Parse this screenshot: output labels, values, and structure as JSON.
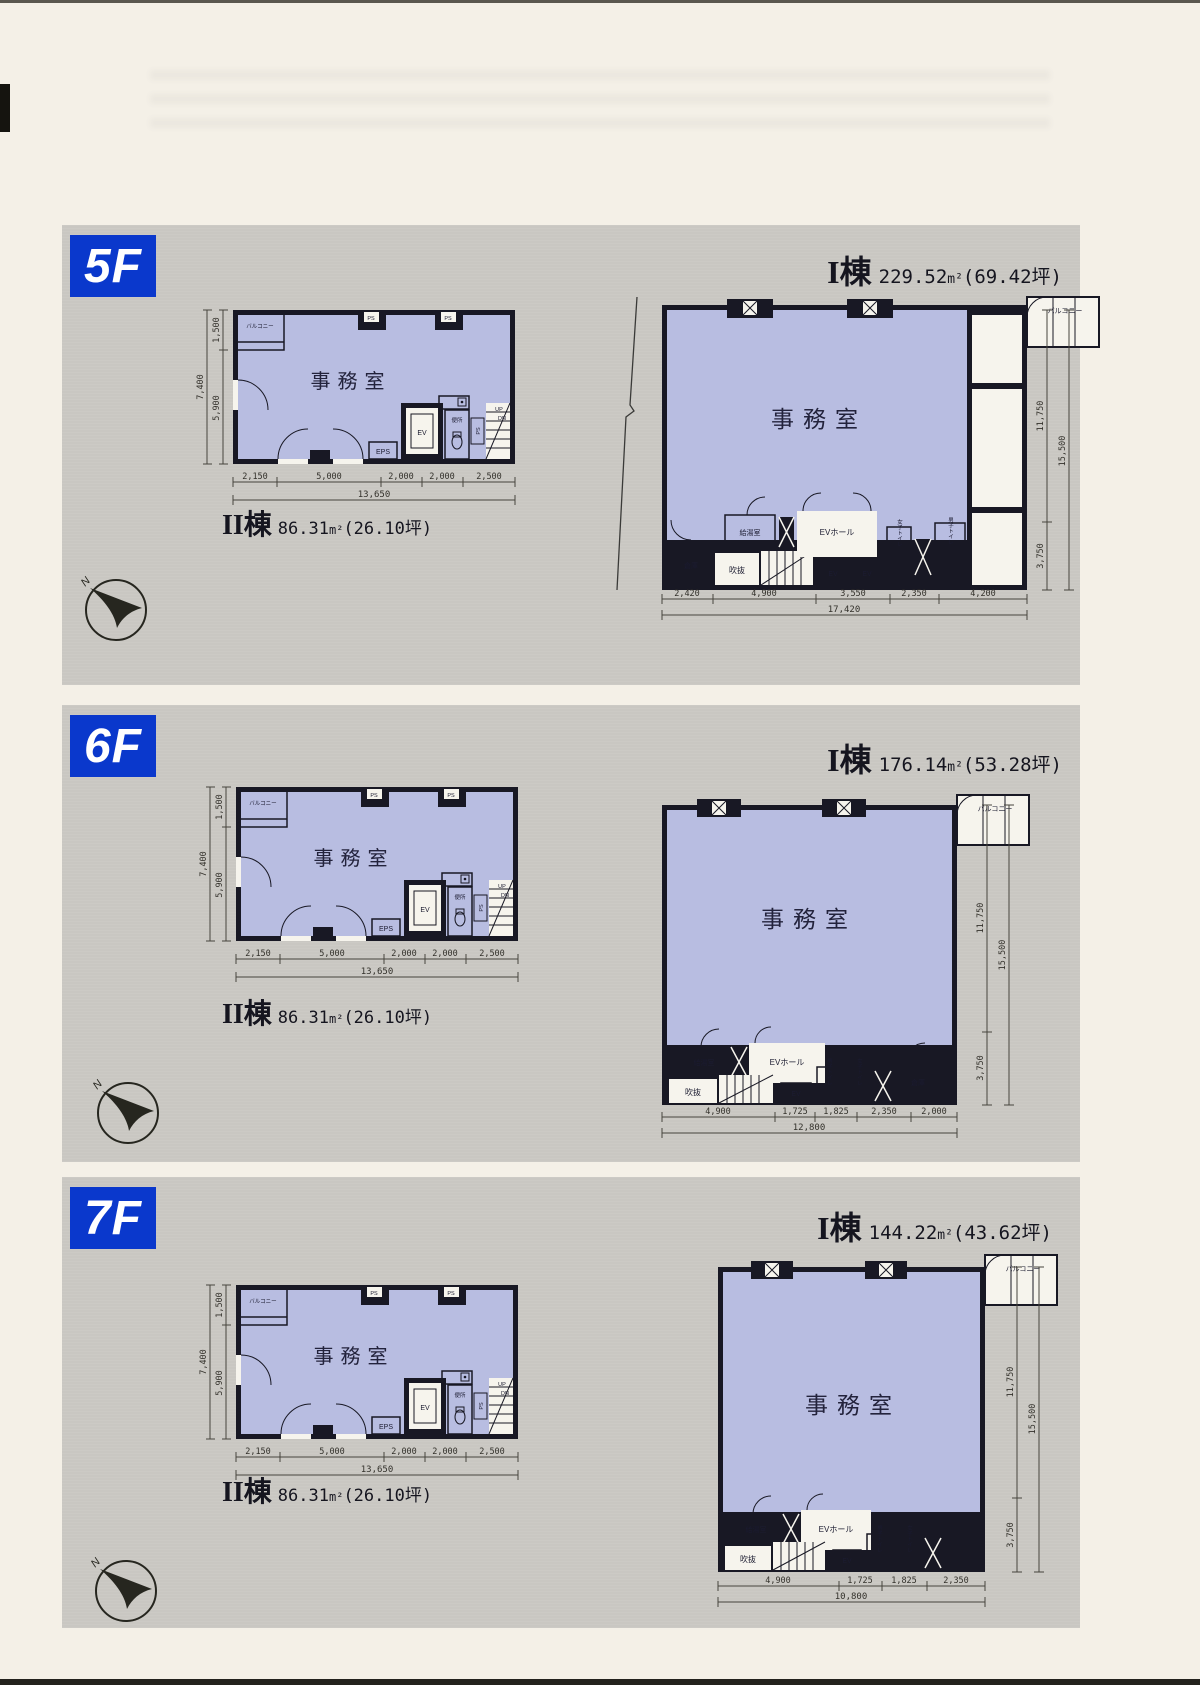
{
  "page": {
    "compass_label": "N"
  },
  "shared": {
    "office": "事務室",
    "balcony": "バルコニー",
    "ev": "EV",
    "ev_hall": "EVホール",
    "kitchenette": "給湯室",
    "toilet": "便所",
    "eps": "EPS",
    "ps": "PS",
    "up": "UP",
    "dn": "DN",
    "void_space": "吹抜",
    "storage": "倉庫",
    "womens_toilet": "女子トイレ",
    "mens_toilet": "男子トイレ"
  },
  "wing2": {
    "name": "II棟",
    "area": "86.31",
    "area_unit": "m²",
    "tsubo": "(26.10坪)",
    "dims_left": [
      "1,500",
      "5,900",
      "7,400"
    ],
    "dims_bottom": [
      "2,150",
      "5,000",
      "2,000",
      "2,000",
      "2,500"
    ],
    "dims_bottom_total": "13,650"
  },
  "floors": [
    {
      "badge": "5F",
      "wing1": {
        "name": "I棟",
        "area": "229.52",
        "area_unit": "m²",
        "tsubo": "(69.42坪)",
        "dims_bottom": [
          "2,420",
          "4,900",
          "3,550",
          "2,350",
          "4,200"
        ],
        "dims_bottom_total": "17,420",
        "dims_right": [
          "11,750",
          "3,750",
          "15,500"
        ]
      }
    },
    {
      "badge": "6F",
      "wing1": {
        "name": "I棟",
        "area": "176.14",
        "area_unit": "m²",
        "tsubo": "(53.28坪)",
        "dims_bottom": [
          "4,900",
          "1,725",
          "1,825",
          "2,350",
          "2,000"
        ],
        "dims_bottom_total": "12,800",
        "dims_right": [
          "11,750",
          "3,750",
          "15,500"
        ]
      }
    },
    {
      "badge": "7F",
      "wing1": {
        "name": "I棟",
        "area": "144.22",
        "area_unit": "m²",
        "tsubo": "(43.62坪)",
        "dims_bottom": [
          "4,900",
          "1,725",
          "1,825",
          "2,350"
        ],
        "dims_bottom_total": "10,800",
        "dims_right": [
          "11,750",
          "3,750",
          "15,500"
        ]
      }
    }
  ]
}
